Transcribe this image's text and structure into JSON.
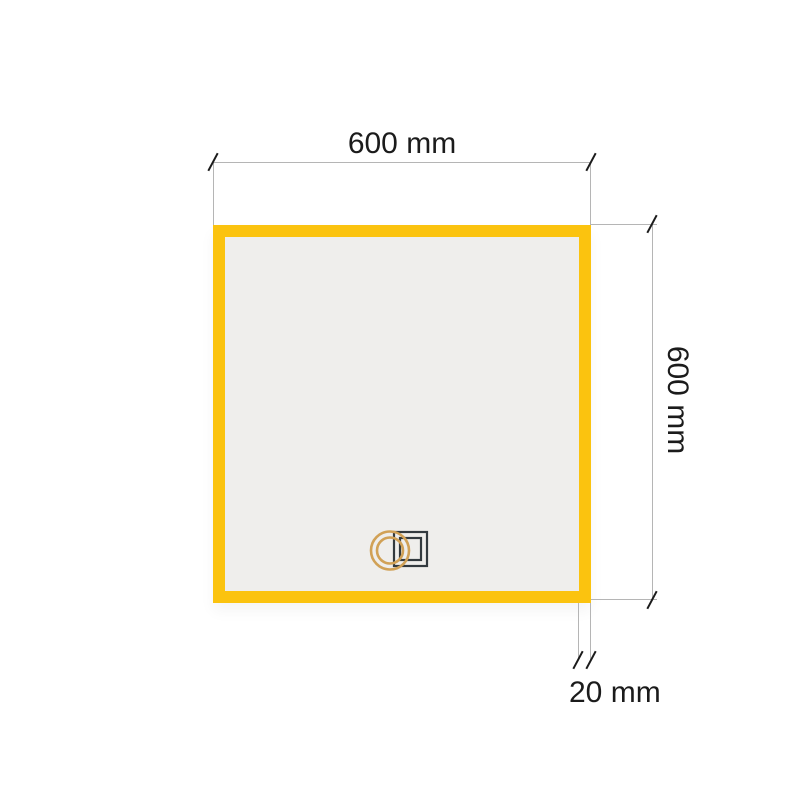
{
  "product": {
    "type": "square-framed-mirror-diagram",
    "frame_color": "#fbc30f",
    "panel_color": "#efeeec",
    "logo": {
      "ring_icon": "double-gold-ring",
      "square_icon": "double-dark-square",
      "ring_color": "#d1a156",
      "square_color": "#333a3f"
    }
  },
  "dimensions": {
    "width": {
      "label": "600 mm",
      "value": 600,
      "unit": "mm"
    },
    "height": {
      "label": "600 mm",
      "value": 600,
      "unit": "mm"
    },
    "frame_thickness": {
      "label": "20 mm",
      "value": 20,
      "unit": "mm"
    }
  },
  "annotation_style": {
    "line_color": "#b5b5b5",
    "tick_color": "#1b1b1b",
    "text_color": "#1b1b1b",
    "background_color": "#ffffff"
  }
}
